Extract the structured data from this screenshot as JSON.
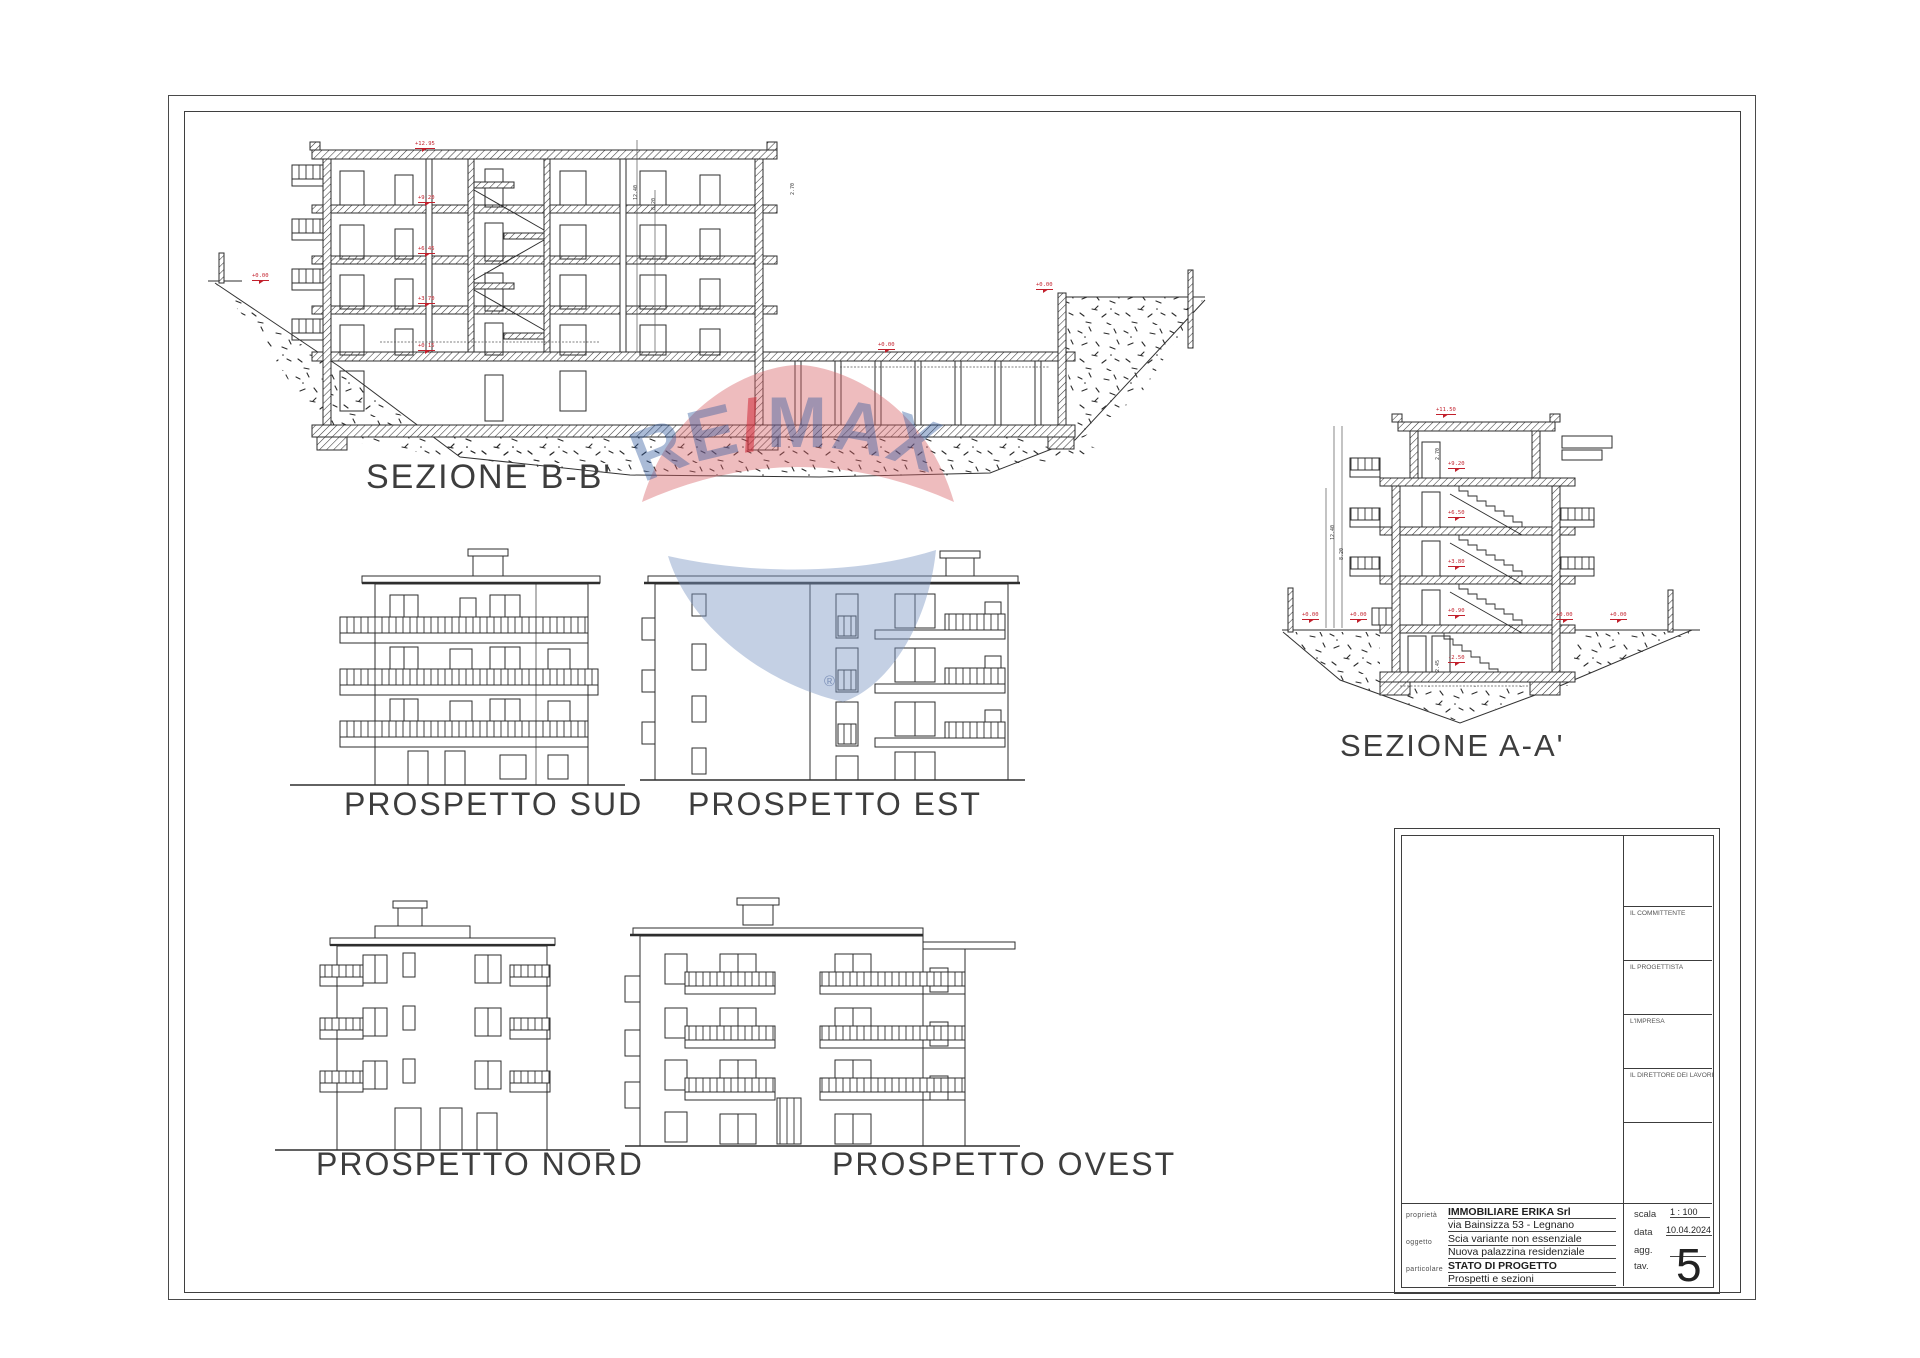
{
  "sheet": {
    "labels": {
      "sezione_bb": "SEZIONE B-B'",
      "sezione_aa": "SEZIONE A-A'",
      "prospetto_sud": "PROSPETTO SUD",
      "prospetto_est": "PROSPETTO EST",
      "prospetto_nord": "PROSPETTO NORD",
      "prospetto_ovest": "PROSPETTO OVEST"
    },
    "colors": {
      "ink": "#2e2e2e",
      "marker_red": "#c2202c"
    }
  },
  "markers": {
    "bb_levels": [
      "+12.95",
      "+9.20",
      "+6.45",
      "+3.70",
      "+0.15"
    ],
    "bb_ground": [
      "+0.00",
      "+0.00",
      "+0.00"
    ],
    "aa_top": "+11.50",
    "aa_levels": [
      "+9.20",
      "+6.50",
      "+3.80",
      "+0.90",
      "-2.50"
    ],
    "aa_ground": [
      "+0.00",
      "+0.00",
      "+0.00",
      "+0.00"
    ],
    "dims": {
      "d270": "2.70",
      "d245": "2.45",
      "d820": "8.20",
      "d1240": "12.40"
    }
  },
  "watermark": {
    "re": "RE",
    "slash": "/",
    "max": "MAX",
    "registered": "®",
    "red": "#ce2130",
    "blue": "#2b549c"
  },
  "title_block": {
    "signatures": [
      "IL COMMITTENTE",
      "IL PROGETTISTA",
      "L'IMPRESA",
      "IL DIRETTORE DEI LAVORI"
    ],
    "fields": {
      "proprieta_label": "proprietà",
      "proprieta_line1": "IMMOBILIARE ERIKA Srl",
      "proprieta_line2": "via Bainsizza 53 - Legnano",
      "oggetto_label": "oggetto",
      "oggetto_line1": "Scia variante non essenziale",
      "oggetto_line2": "Nuova palazzina residenziale",
      "particolare_label": "particolare",
      "particolare_line1": "STATO DI PROGETTO",
      "particolare_line2": "Prospetti e sezioni",
      "scala_label": "scala",
      "scala_value": "1 : 100",
      "data_label": "data",
      "data_value": "10.04.2024",
      "agg_label": "agg.",
      "agg_value": "",
      "tav_label": "tav.",
      "tav_value": "5"
    }
  }
}
